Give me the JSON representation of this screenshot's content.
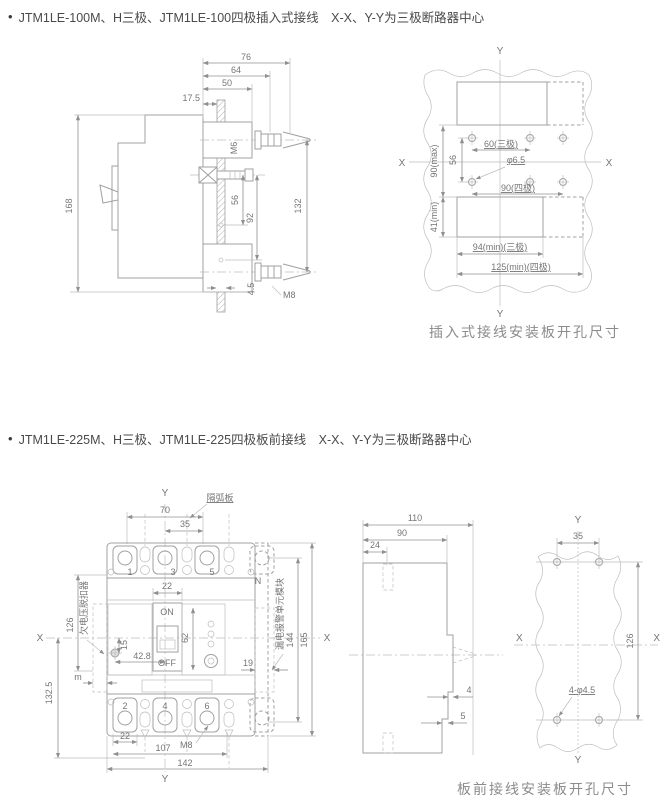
{
  "s1": {
    "bullet": "•",
    "title": "JTM1LE-100M、H三极、JTM1LE-100四极插入式接线　X-X、Y-Y为三极断路器中心",
    "caption": "插入式接线安装板开孔尺寸",
    "side": {
      "d76": "76",
      "d64": "64",
      "d50": "50",
      "d17_5": "17.5",
      "m6": "M6",
      "d168": "168",
      "d56": "56",
      "d92": "92",
      "d132": "132",
      "d4_5": "4.5",
      "m8": "M8"
    },
    "plate": {
      "y": "Y",
      "x": "X",
      "d60": "60(三极)",
      "dia": "φ6.5",
      "d90s": "90(四极)",
      "d90max": "90(max)",
      "d56": "56",
      "d41": "41(min)",
      "d94": "94(min)(三极)",
      "d125": "125(min)(四极)"
    }
  },
  "s2": {
    "bullet": "•",
    "title": "JTM1LE-225M、H三极、JTM1LE-225四极板前接线　X-X、Y-Y为三极断路器中心",
    "caption": "板前接线安装板开孔尺寸",
    "front": {
      "y": "Y",
      "x": "X",
      "arc": "隔弧板",
      "d70": "70",
      "d35": "35",
      "p1": "1",
      "p3": "3",
      "p5": "5",
      "pn": "N",
      "d22": "22",
      "on": "ON",
      "off": "OFF",
      "d62": "62",
      "d15": "15",
      "d42_8": "42.8",
      "d19": "19",
      "uvr": "欠电压脱扣器",
      "leak": "漏电报警单元模块",
      "d126": "126",
      "dm": "m",
      "d132_5": "132.5",
      "d144": "144",
      "d165": "165",
      "p2": "2",
      "p4": "4",
      "p6": "6",
      "m8": "M8",
      "d22b": "22",
      "d107": "107",
      "d142": "142"
    },
    "side": {
      "d110": "110",
      "d90": "90",
      "d24": "24",
      "d4": "4",
      "d5": "5"
    },
    "plate": {
      "y": "Y",
      "x": "X",
      "d35": "35",
      "d126": "126",
      "holes": "4-φ4.5"
    }
  }
}
